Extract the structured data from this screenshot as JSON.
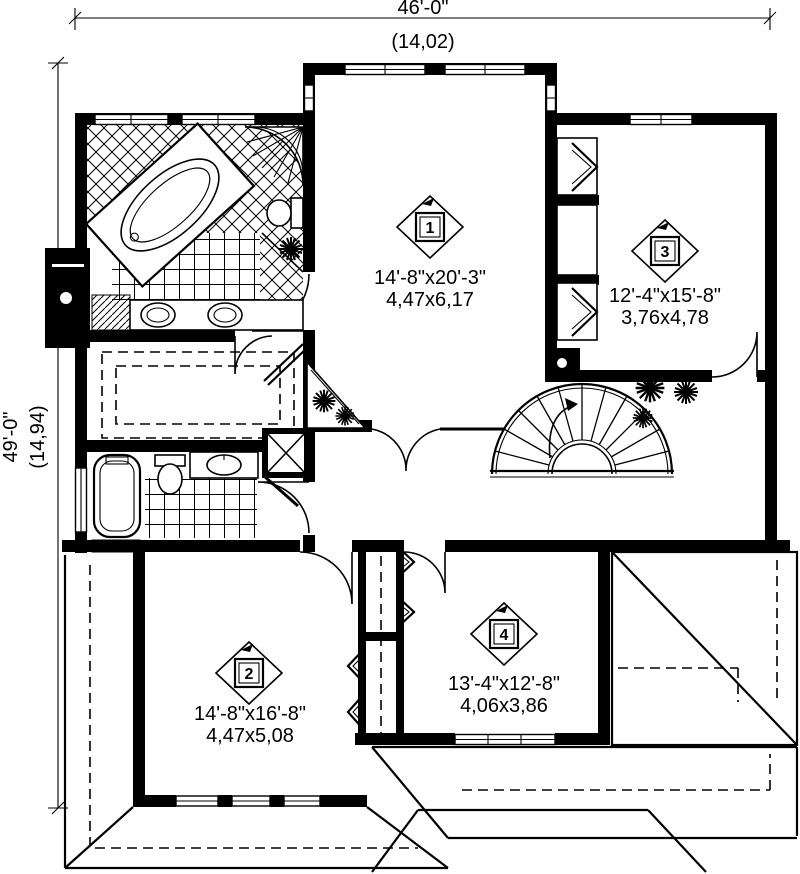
{
  "plan": {
    "top_dimension": {
      "feet": "46'-0\"",
      "meters": "(14,02)"
    },
    "left_dimension": {
      "feet": "49'-0\"",
      "meters": "(14,94)"
    },
    "rooms": [
      {
        "number": "1",
        "feet": "14'-8\"x20'-3\"",
        "meters": "4,47x6,17"
      },
      {
        "number": "2",
        "feet": "14'-8\"x16'-8\"",
        "meters": "4,47x5,08"
      },
      {
        "number": "3",
        "feet": "12'-4\"x15'-8\"",
        "meters": "3,76x4,78"
      },
      {
        "number": "4",
        "feet": "13'-4\"x12'-8\"",
        "meters": "4,06x3,86"
      }
    ],
    "colors": {
      "ink": "#000000",
      "paper": "#ffffff"
    }
  }
}
